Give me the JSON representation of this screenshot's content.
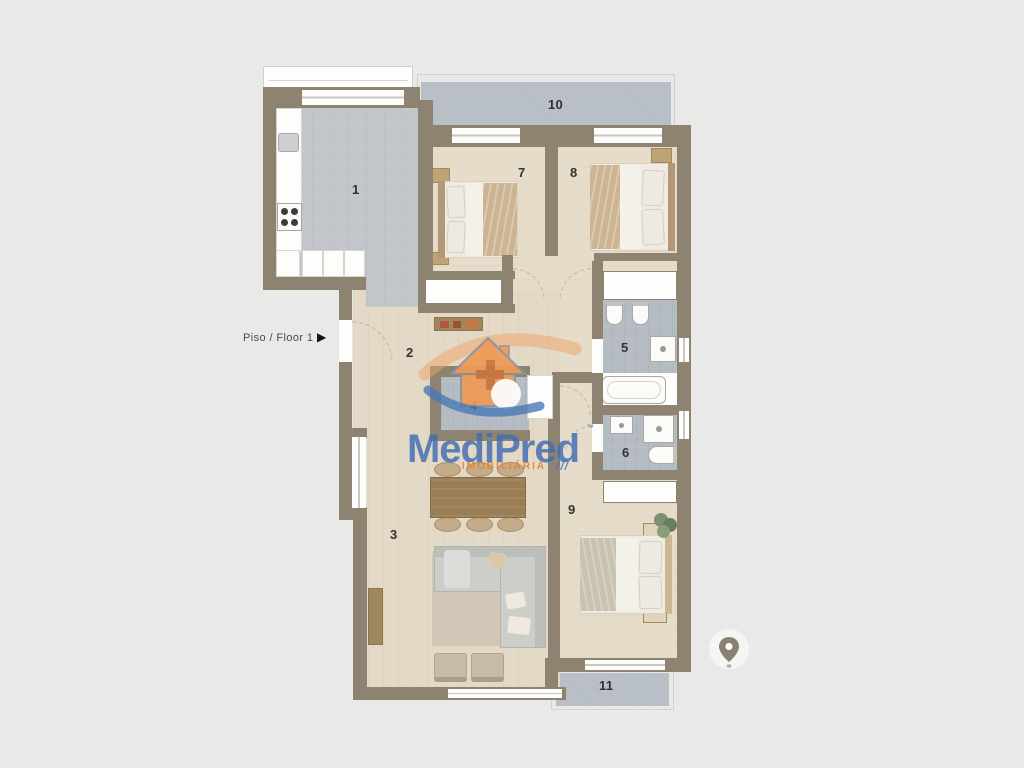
{
  "floor_selector": {
    "label": "Piso / Floor 1",
    "arrow_glyph": "▶"
  },
  "rooms": [
    {
      "number": "1",
      "name": "kitchen"
    },
    {
      "number": "2",
      "name": "entry-hall"
    },
    {
      "number": "3",
      "name": "living-room"
    },
    {
      "number": "4",
      "name": "inner-hall"
    },
    {
      "number": "5",
      "name": "bathroom-main"
    },
    {
      "number": "6",
      "name": "bathroom-second"
    },
    {
      "number": "7",
      "name": "bedroom-1"
    },
    {
      "number": "8",
      "name": "bedroom-2"
    },
    {
      "number": "9",
      "name": "bedroom-master"
    },
    {
      "number": "10",
      "name": "balcony-top"
    },
    {
      "number": "11",
      "name": "balcony-bottom"
    }
  ],
  "watermark": {
    "brand": "MediPred",
    "trademark": "™",
    "tagline": "IMOBILIÁRIA",
    "slashes": "///"
  },
  "icons": {
    "floor_arrow": "right-triangle",
    "location_pin": "map-pin",
    "logo_house": "house-with-cross"
  },
  "colors": {
    "background": "#e9e9e7",
    "wall": "#8e8371",
    "wood_floor": "#e4d9c7",
    "kitchen_tile": "#c2c6cb",
    "bath_tile": "#b5bbc2",
    "balcony_tile": "#b8bec5",
    "brand_blue": "#3e6db1",
    "brand_orange": "#e9913f"
  }
}
